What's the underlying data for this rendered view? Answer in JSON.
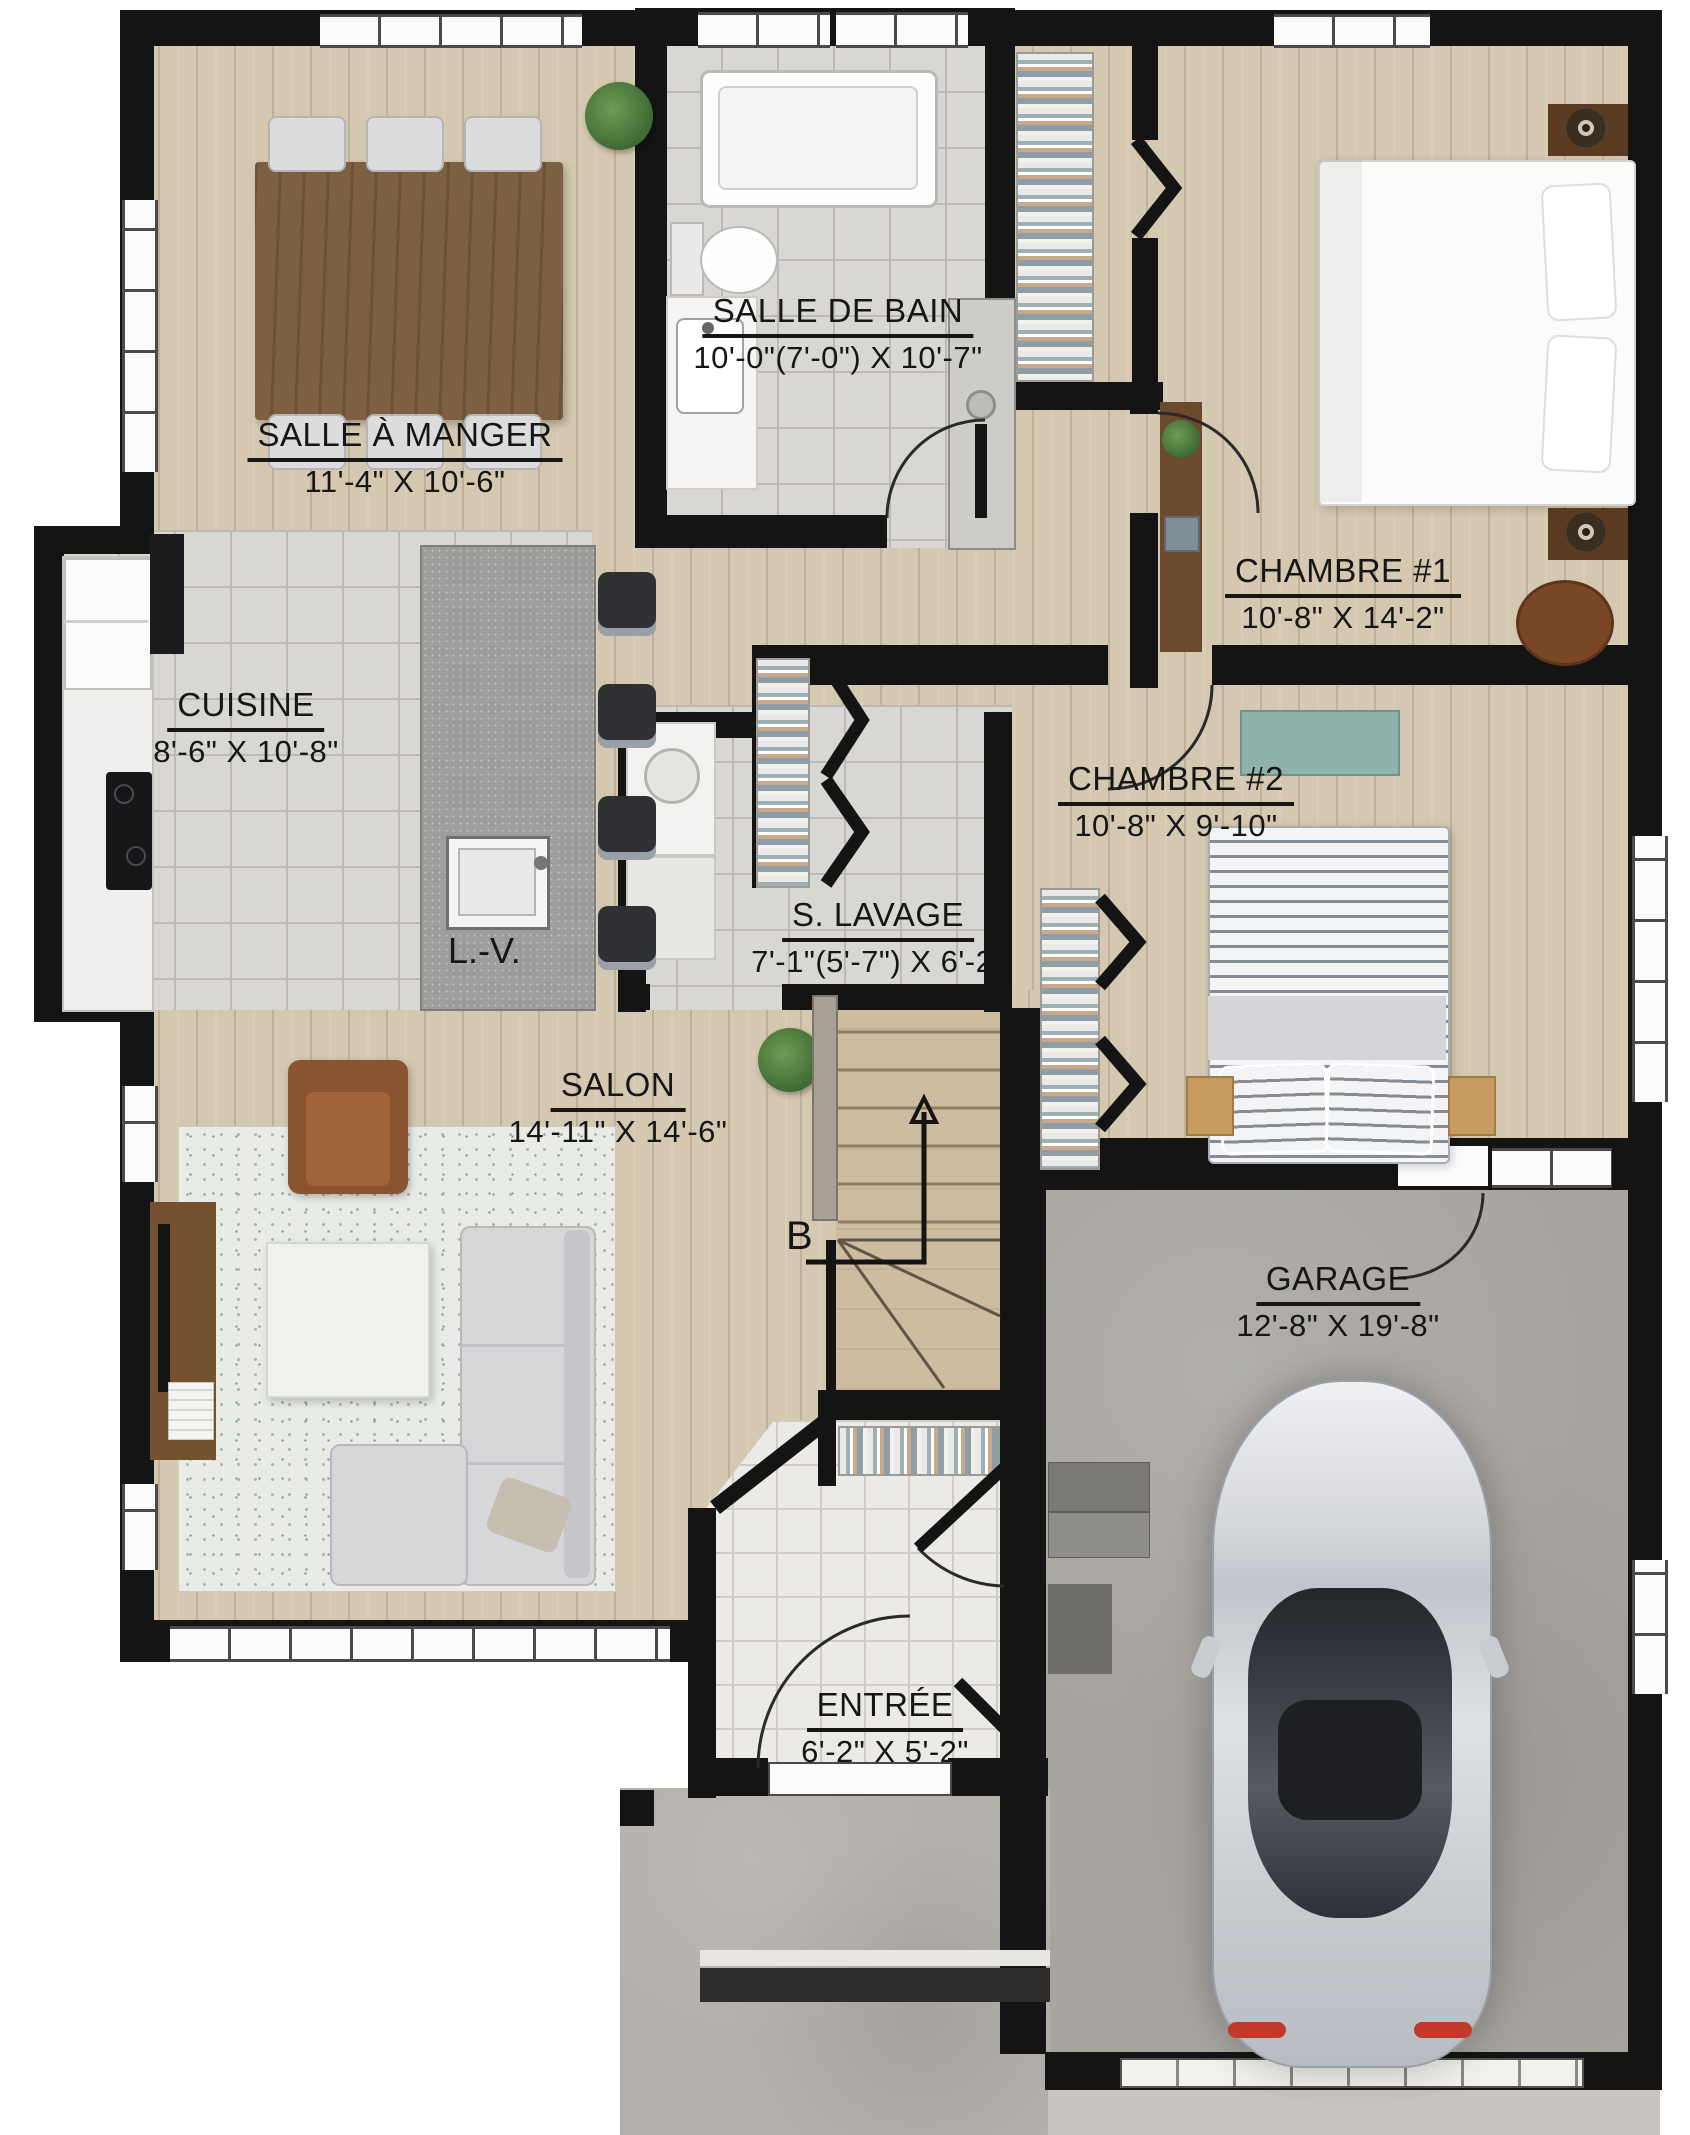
{
  "plan": {
    "rooms": [
      {
        "name": "SALLE À MANGER",
        "dims": "11'-4\" X 10'-6\""
      },
      {
        "name": "SALLE DE BAIN",
        "dims": "10'-0\"(7'-0\") X 10'-7\""
      },
      {
        "name": "CHAMBRE #1",
        "dims": "10'-8\" X 14'-2\""
      },
      {
        "name": "CUISINE",
        "dims": "8'-6\" X 10'-8\""
      },
      {
        "name": "CHAMBRE #2",
        "dims": "10'-8\" X 9'-10\""
      },
      {
        "name": "S. LAVAGE",
        "dims": "7'-1\"(5'-7\") X 6'-2\""
      },
      {
        "name": "SALON",
        "dims": "14'-11\" X 14'-6\""
      },
      {
        "name": "GARAGE",
        "dims": "12'-8\" X 19'-8\""
      },
      {
        "name": "ENTRÉE",
        "dims": "6'-2\" X 5'-2\""
      }
    ],
    "annotations": {
      "dishwasher": "L.-V.",
      "stair_direction": "B"
    },
    "palette": {
      "wall": "#141414",
      "wood": "#d5c8b0",
      "tile": "#d9d7d3",
      "entry_tile": "#eceae7",
      "concrete": "#a8a5a1",
      "island": "#9d9d9b",
      "accent_teal": "#8fb3ac",
      "leather": "#8a5430"
    }
  }
}
